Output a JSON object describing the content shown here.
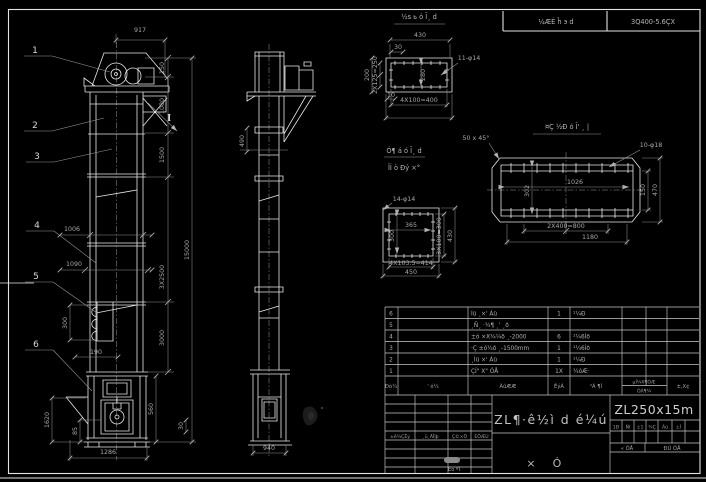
{
  "colors": {
    "background": "#000000",
    "geometry": "#e8e8e8",
    "dimension": "#a0a0a0",
    "text": "#c8c8c8"
  },
  "header_strip": {
    "left": "¼ÆÈ ĥ э d",
    "right": "3Q400-5.6ÇX"
  },
  "callouts": {
    "c1": "1",
    "c2": "2",
    "c3": "3",
    "c4": "4",
    "c5": "5",
    "c6": "6"
  },
  "front_view": {
    "d917": "917",
    "d150": "150",
    "d1080": "1080",
    "d1500": "1500",
    "d3x2500": "3X2500",
    "d3000": "3000",
    "d15000": "15000",
    "d560": "560",
    "d30": "30",
    "d1006": "1006",
    "d1090": "1090",
    "d300": "300",
    "d190": "190",
    "d1620": "1620",
    "d85": "85",
    "d1286": "1286",
    "section_mark": "I"
  },
  "side_view": {
    "d490": "490",
    "d940": "940"
  },
  "detail_top_flange": {
    "title": "½s ь ó Ĩ¸ d",
    "d430": "430",
    "d30": "30",
    "holes": "11-φ14",
    "d200": "200",
    "d2x125": "2X125=250",
    "d280": "280",
    "d10": "10",
    "d4x100": "4X100=400"
  },
  "detail_square_flange": {
    "title_line1": "Ó¶ á ó Ĩ¸ d",
    "title_line2": "ÎÍ ò Ðý ×°",
    "holes": "14-φ14",
    "d365": "365",
    "d300": "300",
    "d3x100": "3X100=300",
    "d430": "430",
    "d4x103": "4X103.5=414",
    "d450": "450"
  },
  "detail_long_flange": {
    "title": "¤Ç ½Ð ó Ĩ' ¸ |",
    "chamfer_note": "50 x 45°",
    "holes": "10-φ18",
    "d1026": "1026",
    "d302": "302",
    "d150": "150",
    "d470": "470",
    "d2x400": "2X400=800",
    "d1180": "1180"
  },
  "parts_table": {
    "headers": {
      "no": "Ðò¼",
      "code": "' ó¼",
      "name": "ÃûÆÆ",
      "qty": "ÊýÁ",
      "material": "²Á ¶Ì",
      "weight_top": "µÌ¼X¶ÒÆ",
      "weight_bottom": "ÓÃ¶¼",
      "note": "±,X¢"
    },
    "rows": [
      {
        "no": "6",
        "code": "",
        "name": "Íü ¸×' Áü",
        "qty": "1",
        "material": "¹¼Ð",
        "note": ""
      },
      {
        "no": "5",
        "code": "",
        "name": "¸Ñ¸ ·¾¶ ¸' ¸ð",
        "qty": "",
        "material": "",
        "note": ""
      },
      {
        "no": "4",
        "code": "",
        "name": "±ó ×X¾¼ð ¸-2000",
        "qty": "6",
        "material": "¹¼6Íð",
        "note": ""
      },
      {
        "no": "3",
        "code": "",
        "name": "·Ç ±ó¼ð ¸-1500mm",
        "qty": "1",
        "material": "¹¼6Íð",
        "note": ""
      },
      {
        "no": "2",
        "code": "",
        "name": "¸Íü ×' Áü",
        "qty": "1",
        "material": "¹¼Ð",
        "note": ""
      },
      {
        "no": "1",
        "code": "",
        "name": "ÇÍ\" X\" ÓÅ",
        "qty": "1X",
        "material": "¼óÆ·",
        "note": ""
      }
    ]
  },
  "title_block": {
    "drawing_title": "ZL¶·ê½ì d é¼ú",
    "model": "ZL250x15m",
    "sub_left": "×",
    "sub_right": "Ó",
    "attr_cells": [
      "1Ð",
      "Ñl",
      "±1",
      "¾Ç",
      "Ãü",
      "±Ì"
    ],
    "sheets_total": "« ÕÅ",
    "sheet_number": "ÐÚ ÕÅ",
    "rev_headers": [
      "±ê¼ÇÊý",
      "¸ü¸ÄÎļþ",
      "Ç©×Ö",
      "ÈÕÆÚ"
    ],
    "approve_label": "Éó ºÌ"
  }
}
